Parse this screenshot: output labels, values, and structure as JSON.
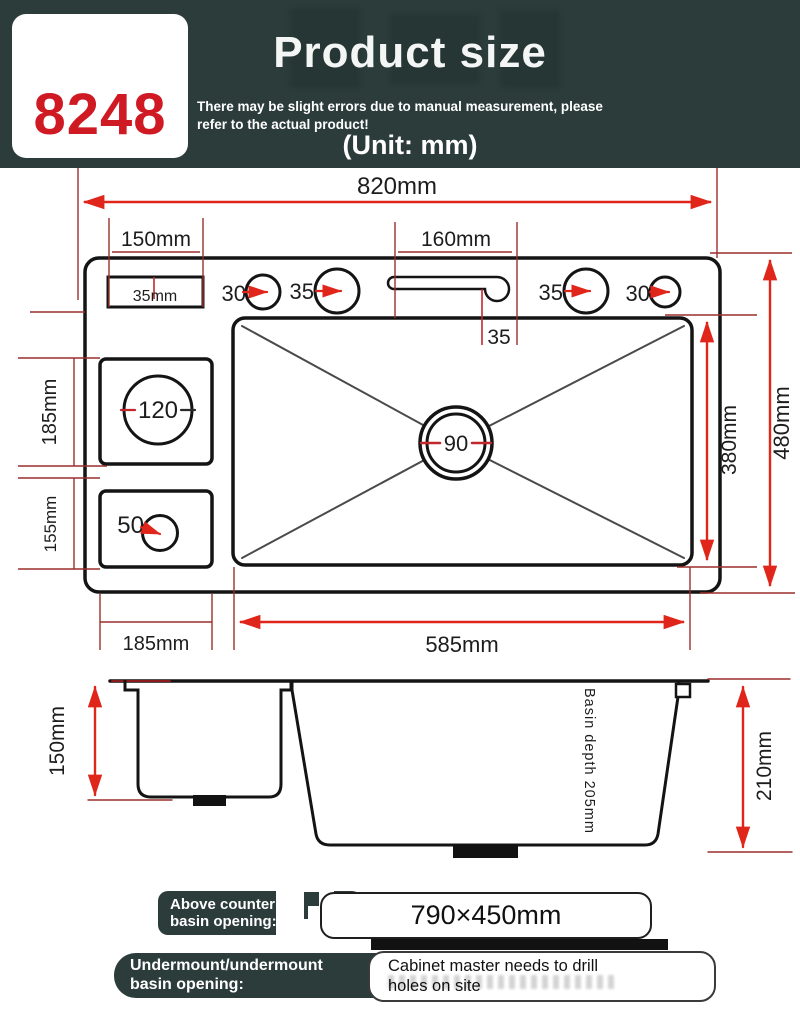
{
  "header": {
    "model": "8248",
    "title": "Product size",
    "disclaimer_line1": "There may be slight errors due to manual measurement, please",
    "disclaimer_line2": "refer to the actual product!",
    "unit": "(Unit: mm)"
  },
  "colors": {
    "header_bg": "#2b3c3a",
    "accent_red": "#cf1a24",
    "arrow_red": "#e0251b",
    "dim_line_maroon": "#9c2f2a",
    "outline_black": "#141414"
  },
  "top_view": {
    "overall_width_label": "820mm",
    "left_span_label": "150mm",
    "overflow_rect_label": "35mm",
    "holes": [
      "30",
      "35",
      "35",
      "30"
    ],
    "slot_width_label": "160mm",
    "slot_offset_label": "35",
    "cup_holder_label": "120",
    "drain_label": "90",
    "soap_hole_label": "50",
    "left_upper_label": "185mm",
    "left_lower_label": "155mm",
    "basin_height_label": "380mm",
    "total_height_label": "480mm",
    "bottom_left_label": "185mm",
    "basin_width_label": "585mm"
  },
  "side_view": {
    "left_depth_label": "150mm",
    "right_depth_label": "210mm",
    "basin_depth_label": "Basin depth 205mm"
  },
  "footer": {
    "row1_label_line1": "Above counter",
    "row1_label_line2": "basin opening:",
    "row1_value": "790×450mm",
    "row2_label_line1": "Undermount/undermount",
    "row2_label_line2": "basin opening:",
    "row2_value_line1": "Cabinet master needs to drill",
    "row2_value_line2": "holes on site"
  }
}
